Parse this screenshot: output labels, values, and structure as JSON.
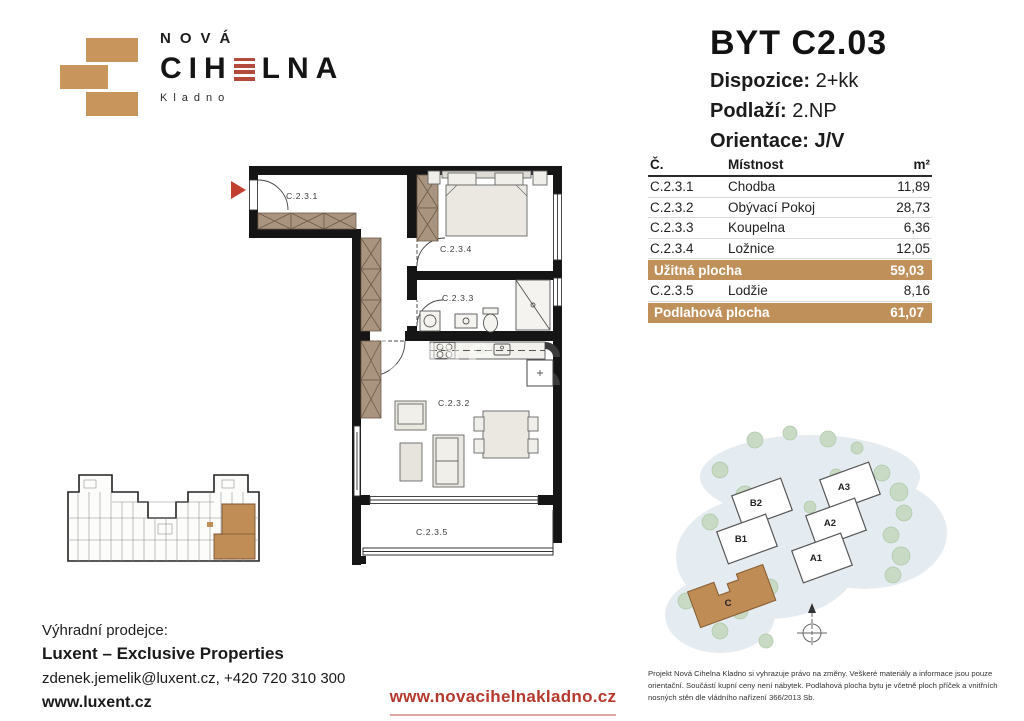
{
  "logo": {
    "nova": "NOVÁ",
    "cihelna_left": "CIH",
    "cihelna_right": "LNA",
    "city": "Kladno"
  },
  "header": {
    "title": "BYT C2.03",
    "dispozice_label": "Dispozice:",
    "dispozice_value": "2+kk",
    "podlazi_label": "Podlaží:",
    "podlazi_value": "2.NP",
    "orientace_label": "Orientace:",
    "orientace_value": "J/V"
  },
  "table": {
    "headers": {
      "number": "Č.",
      "room": "Místnost",
      "area": "m²"
    },
    "rows": [
      {
        "no": "C.2.3.1",
        "name": "Chodba",
        "area": "11,89"
      },
      {
        "no": "C.2.3.2",
        "name": "Obývací Pokoj",
        "area": "28,73"
      },
      {
        "no": "C.2.3.3",
        "name": "Koupelna",
        "area": "6,36"
      },
      {
        "no": "C.2.3.4",
        "name": "Ložnice",
        "area": "12,05"
      }
    ],
    "subtotal": {
      "label": "Užitná plocha",
      "value": "59,03"
    },
    "loggia_row": {
      "no": "C.2.3.5",
      "name": "Lodžie",
      "area": "8,16"
    },
    "total": {
      "label": "Podlahová plocha",
      "value": "61,07"
    }
  },
  "plan": {
    "labels": {
      "chodba": "C.2.3.1",
      "loznice": "C.2.3.4",
      "koupelna": "C.2.3.3",
      "obyvaci": "C.2.3.2",
      "lodzie": "C.2.3.5"
    }
  },
  "site": {
    "buildings": {
      "b2": "B2",
      "b1": "B1",
      "a3": "A3",
      "a2": "A2",
      "a1": "A1",
      "c": "C"
    }
  },
  "footer": {
    "seller_intro": "Výhradní prodejce:",
    "seller_name": "Luxent – Exclusive Properties",
    "contact": "zdenek.jemelik@luxent.cz, +420 720 310 300",
    "seller_url": "www.luxent.cz",
    "project_url": "www.novacihelnakladno.cz",
    "disclaimer": "Projekt Nová Cihelna Kladno si vyhrazuje právo na změny. Veškeré materiály a informace jsou pouze orientační. Součástí kupní ceny není nábytek. Podlahová plocha bytu je včetně ploch příček a vnitřních nosných stěn dle vládního nařízení 366/2013 Sb."
  },
  "colors": {
    "brick": "#c0905a",
    "accent_red": "#b5392d",
    "wall": "#151515"
  }
}
